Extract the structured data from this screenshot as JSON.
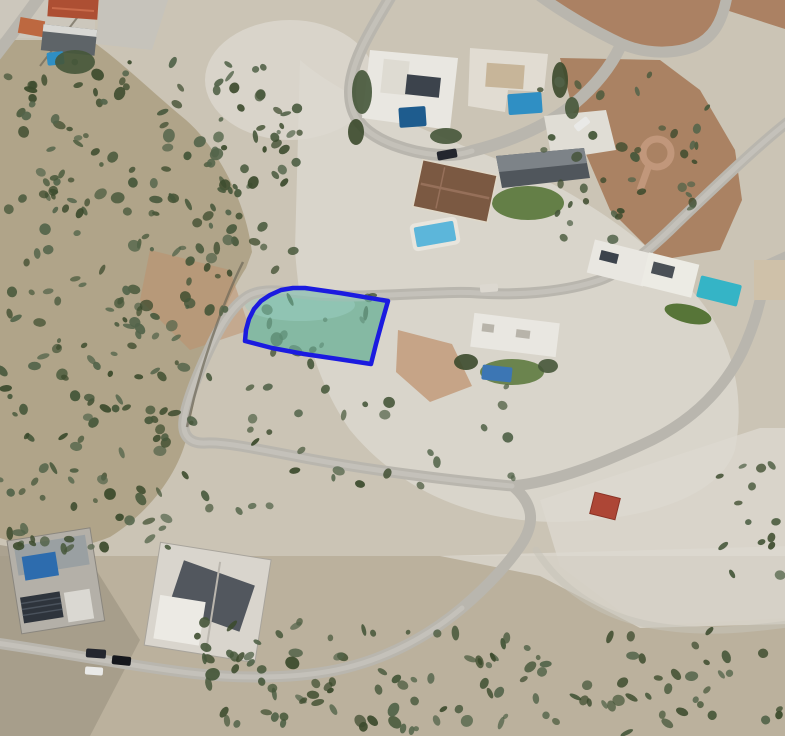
{
  "map": {
    "view": "satellite-aerial",
    "scene": "hillside residential development with roads, villas, pools, scrubland and vacant plots",
    "plot_highlight": {
      "label": "highlighted land plot",
      "outline_color": "#1b1be0",
      "outline_width": "4.5",
      "fill_color": "rgba(124,202,184,0.5)",
      "underlay_color": "#8fa98f",
      "points": "245,341 246,330 249,319 254,309 261,301 270,295 281,290 293,288 305,288 340,293 388,301 382,322 376,344 371,364 338,359 304,354 272,348"
    },
    "palette": {
      "terrain_base": "#cbc4b5",
      "terrain_scrub": "#b0a489",
      "terrain_bright": "#dcd8cf",
      "terrain_red": "#a87e5f",
      "terrain_red_top": "#ab8163",
      "terrain_tan": "#bd8e6a",
      "terrain_bottom": "#b5ab96",
      "terrain_corner": "#a39a87",
      "road": "#b9b6ae",
      "road_core": "#c9c6bf",
      "track": "#c6c2b8",
      "wall": "#6e6858",
      "lawn": "#577538",
      "veg_dark": "#3b4a2c",
      "veg_mid": "#46573a",
      "veg_light": "#53644a",
      "pool_dark": "#1e5c8e",
      "pool_blue": "#2f8fc4",
      "pool_light": "#5cb6da",
      "pool_teal": "#35b4c6",
      "pool_tarp": "#3c76b4",
      "roof_red": "#ad4f33",
      "roof_orange": "#bd6840",
      "roof_brown": "#7b5942",
      "roof_dark": "#3c434c",
      "roof_slate": "#50565c",
      "building_white": "#e9e7e1",
      "building_gray": "#b4b0a8",
      "building_construction": "#d9d5cd",
      "shed_red": "#ad4636",
      "solar_panel": "#2e343c",
      "blue_roof": "#2d6cae",
      "car_dark": "#23262e",
      "car_white": "#e9e9e7",
      "paved_circle": "#c49a7e"
    }
  }
}
